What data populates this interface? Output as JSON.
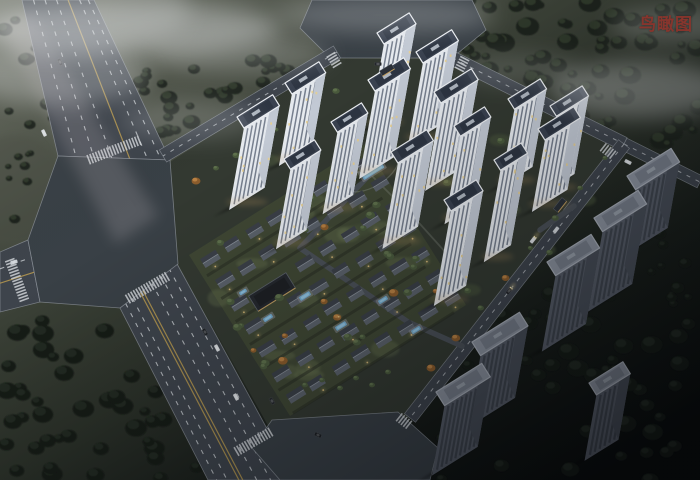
{
  "header": {
    "view_label": "鸟瞰图"
  },
  "palette": {
    "label_red": "#8b342c",
    "road": "#3e444c",
    "plaza": "#394046",
    "curb": "#949aa3",
    "lane_white": "#d7dbdf",
    "lane_yellow": "#bb9c4f",
    "site_ground": "#333931",
    "villa_ground": "#3f4734",
    "lawn": "#76835a",
    "tower_face": "#e6eaef",
    "tower_side": "#c2c9d4",
    "tower_win": "#5b6576",
    "tower_lit": "#e8cf8f",
    "tower_roof": "#3a4250",
    "tower_trim": "#edf0f4",
    "tower_roof_inner": "#2d3542",
    "ctx_face": "#565c67",
    "ctx_side": "#474d57",
    "ctx_rib": "#3d434c",
    "ctx_roof": "#8a919d",
    "villa_roof_front": "#5a616a",
    "villa_roof_back": "#3b4048",
    "villa_ridge": "#878e97",
    "clubhouse": "#25282e",
    "warm": "#cda55f",
    "tree_dark": "#1d231d",
    "tree_dark_hl": "#343d2e",
    "tree_deep": "#141a15",
    "tree_deep_hl": "#262e24",
    "tree_green": "#49593c",
    "tree_green_hl": "#647650",
    "autumn": "#8a5c2c",
    "autumn_hl": "#c28a4a",
    "pool": "#74accf",
    "pool_hl": "#a9d2e8",
    "fog": "#eef0f2"
  },
  "scene": {
    "canvas": {
      "w": 700,
      "h": 480
    },
    "site_polygon": [
      [
        170,
        162
      ],
      [
        334,
        58
      ],
      [
        460,
        60
      ],
      [
        622,
        145
      ],
      [
        412,
        416
      ],
      [
        296,
        476
      ],
      [
        178,
        264
      ]
    ],
    "villa": {
      "origin": [
        210,
        258
      ],
      "rows": 7,
      "cols": 8,
      "row_step": 27,
      "col_step": 26,
      "field": [
        [
          189,
          255
        ],
        [
          365,
          144
        ],
        [
          466,
          305
        ],
        [
          290,
          416
        ]
      ],
      "clubhouse": {
        "x": 272,
        "y": 292,
        "w": 44,
        "d": 18
      },
      "skip_near": [
        272,
        292,
        26
      ],
      "tree_count": 26,
      "lawn_patches": 14
    },
    "towers": [
      [
        377,
        33,
        38,
        13,
        85
      ],
      [
        416,
        52,
        42,
        13,
        82
      ],
      [
        285,
        83,
        40,
        13,
        72
      ],
      [
        368,
        80,
        42,
        13,
        88
      ],
      [
        434,
        92,
        44,
        13,
        88
      ],
      [
        508,
        99,
        38,
        12,
        78
      ],
      [
        550,
        106,
        38,
        12,
        78
      ],
      [
        237,
        117,
        42,
        13,
        82
      ],
      [
        331,
        122,
        36,
        12,
        82
      ],
      [
        454,
        126,
        36,
        12,
        88
      ],
      [
        538,
        129,
        42,
        13,
        72
      ],
      [
        284,
        159,
        36,
        12,
        80
      ],
      [
        391,
        152,
        42,
        13,
        86
      ],
      [
        494,
        160,
        32,
        12,
        92
      ],
      [
        444,
        200,
        38,
        13,
        95
      ]
    ],
    "context_buildings": [
      [
        627,
        176,
        52,
        16,
        66
      ],
      [
        594,
        218,
        52,
        16,
        80
      ],
      [
        547,
        262,
        52,
        16,
        76
      ],
      [
        472,
        342,
        56,
        16,
        72
      ],
      [
        436,
        392,
        54,
        16,
        70
      ],
      [
        589,
        383,
        40,
        14,
        66
      ]
    ],
    "roads": {
      "wide": [
        {
          "name": "avenue-northwest",
          "e1": [
            [
              22,
              0
            ],
            [
              58,
              156
            ]
          ],
          "e2": [
            [
              94,
              0
            ],
            [
              170,
              160
            ]
          ],
          "dashes": [
            0.16,
            0.32,
            0.48,
            0.8,
            0.92
          ],
          "yellow": [
            0.64
          ]
        },
        {
          "name": "avenue-south",
          "e1": [
            [
              176,
              262
            ],
            [
              295,
              480
            ]
          ],
          "e2": [
            [
              120,
              308
            ],
            [
              208,
              480
            ]
          ],
          "dashes": [
            0.13,
            0.28,
            0.44,
            0.78,
            0.9
          ],
          "yellow": [
            0.6,
            0.645
          ]
        },
        {
          "name": "street-west",
          "e1": [
            [
              0,
              252
            ],
            [
              28,
              240
            ]
          ],
          "e2": [
            [
              0,
              312
            ],
            [
              40,
              302
            ]
          ],
          "dashes": [
            0.28
          ],
          "yellow": [
            0.52
          ]
        }
      ],
      "simple": [
        {
          "name": "street-site-northwest",
          "a": [
            337,
            52
          ],
          "b": [
            163,
            156
          ],
          "w": 14,
          "dash": true
        },
        {
          "name": "street-site-northeast",
          "a": [
            452,
            58
          ],
          "b": [
            624,
            144
          ],
          "w": 14,
          "dash": true
        },
        {
          "name": "street-east-exit",
          "a": [
            624,
            144
          ],
          "b": [
            700,
            182
          ],
          "w": 13,
          "dash": true
        },
        {
          "name": "street-site-east",
          "a": [
            624,
            144
          ],
          "b": [
            410,
            418
          ],
          "w": 14,
          "dash": true
        },
        {
          "name": "street-north-stub",
          "a": [
            390,
            56
          ],
          "b": [
            384,
            88
          ],
          "w": 10,
          "dash": false
        }
      ],
      "plazas": [
        {
          "name": "intersection-north",
          "pts": [
            [
              312,
              0
            ],
            [
              472,
              0
            ],
            [
              486,
              30
            ],
            [
              452,
              58
            ],
            [
              330,
              58
            ],
            [
              300,
              28
            ]
          ]
        },
        {
          "name": "intersection-west",
          "pts": [
            [
              58,
              156
            ],
            [
              170,
              160
            ],
            [
              178,
              264
            ],
            [
              120,
              308
            ],
            [
              40,
              302
            ],
            [
              28,
              240
            ]
          ]
        },
        {
          "name": "intersection-south",
          "pts": [
            [
              272,
              420
            ],
            [
              398,
              412
            ],
            [
              438,
              448
            ],
            [
              430,
              480
            ],
            [
              280,
              480
            ],
            [
              252,
              448
            ]
          ]
        }
      ],
      "zebras": [
        [
          114,
          150,
          69,
          54
        ],
        [
          147,
          288,
          60,
          46
        ],
        [
          17,
          280,
          -20,
          42
        ],
        [
          334,
          60,
          -31,
          12
        ],
        [
          462,
          64,
          27,
          12
        ],
        [
          608,
          151,
          -52,
          12
        ],
        [
          404,
          421,
          -52,
          12
        ],
        [
          253,
          442,
          60,
          40
        ]
      ],
      "drives": [
        [
          [
            386,
            84
          ],
          [
            372,
            172
          ],
          [
            300,
            248
          ]
        ],
        [
          [
            300,
            248
          ],
          [
            408,
            322
          ],
          [
            462,
            346
          ]
        ],
        [
          [
            540,
            230
          ],
          [
            574,
            206
          ]
        ]
      ]
    },
    "forest": [
      {
        "name": "forest-northeast",
        "rect": [
          408,
          0,
          292,
          150
        ],
        "n": 62,
        "rmin": 4,
        "rmax": 12,
        "clip": "ne",
        "deep": false
      },
      {
        "name": "forest-north-band",
        "rect": [
          140,
          58,
          205,
          84
        ],
        "n": 26,
        "rmin": 4,
        "rmax": 9,
        "clip": "nw",
        "deep": false
      },
      {
        "name": "forest-northwest-corner",
        "rect": [
          0,
          16,
          82,
          118
        ],
        "n": 15,
        "rmin": 4,
        "rmax": 9,
        "deep": false
      },
      {
        "name": "forest-west-strip",
        "rect": [
          0,
          132,
          44,
          88
        ],
        "n": 8,
        "rmin": 3,
        "rmax": 6,
        "deep": false
      },
      {
        "name": "forest-southwest",
        "rect": [
          0,
          320,
          215,
          160
        ],
        "n": 44,
        "rmin": 5,
        "rmax": 11,
        "clip": "sw",
        "deep": true
      },
      {
        "name": "forest-southeast",
        "rect": [
          430,
          294,
          270,
          186
        ],
        "n": 48,
        "rmin": 5,
        "rmax": 11,
        "clip": "se",
        "deep": true
      },
      {
        "name": "forest-east-strip",
        "rect": [
          646,
          222,
          54,
          96
        ],
        "n": 10,
        "rmin": 3,
        "rmax": 7,
        "deep": true
      }
    ],
    "tower_lawns": [
      [
        268,
        160
      ],
      [
        310,
        200
      ],
      [
        360,
        230
      ],
      [
        420,
        260
      ],
      [
        470,
        290
      ],
      [
        300,
        130
      ],
      [
        390,
        150
      ],
      [
        450,
        180
      ],
      [
        510,
        210
      ],
      [
        545,
        250
      ],
      [
        430,
        120
      ],
      [
        500,
        140
      ],
      [
        560,
        170
      ],
      [
        585,
        200
      ]
    ],
    "south_trees": [
      [
        305,
        385
      ],
      [
        322,
        380
      ],
      [
        340,
        388
      ],
      [
        356,
        378
      ],
      [
        372,
        385
      ],
      [
        388,
        372
      ]
    ],
    "edge_trees": {
      "a": [
        190,
        175
      ],
      "b": [
        330,
        85
      ],
      "n": 8
    },
    "road_trees": {
      "a": [
        614,
        160
      ],
      "b": [
        440,
        370
      ],
      "n": 8
    },
    "pools": [
      [
        372,
        170,
        24,
        9
      ],
      [
        268,
        318,
        10,
        4
      ],
      [
        305,
        296,
        12,
        4.5
      ],
      [
        341,
        326,
        12,
        4.5
      ],
      [
        383,
        300,
        10,
        4
      ],
      [
        416,
        330,
        10,
        4
      ],
      [
        243,
        292,
        8,
        3.5
      ]
    ],
    "cars": [
      [
        44,
        133,
        65,
        "#dde1e4",
        0
      ],
      [
        60,
        62,
        65,
        "#2a2e33",
        0
      ],
      [
        378,
        64,
        0,
        "#23262b",
        0
      ],
      [
        14,
        262,
        -15,
        "#ccd1d6",
        0
      ],
      [
        533,
        240,
        -52,
        "#d9dde1",
        1
      ],
      [
        556,
        230,
        -52,
        "#ced3d8",
        0
      ],
      [
        509,
        291,
        -52,
        "#24272c",
        1
      ],
      [
        217,
        348,
        62,
        "#d9dde0",
        0
      ],
      [
        236,
        397,
        62,
        "#d9dde0",
        0
      ],
      [
        272,
        401,
        62,
        "#26292d",
        0
      ],
      [
        318,
        435,
        25,
        "#1c1f23",
        0
      ],
      [
        205,
        332,
        62,
        "#202428",
        0
      ],
      [
        628,
        162,
        27,
        "#d6dade",
        0
      ]
    ],
    "gates": [
      {
        "x": 387,
        "y": 70,
        "rot": -31
      },
      {
        "x": 560,
        "y": 205,
        "rot": -52
      }
    ],
    "fog": [
      [
        130,
        28,
        150,
        26,
        0.42
      ],
      [
        60,
        75,
        90,
        30,
        0.3
      ],
      [
        240,
        55,
        90,
        18,
        0.22
      ],
      [
        385,
        15,
        110,
        18,
        0.25
      ],
      [
        640,
        90,
        90,
        28,
        0.33
      ],
      [
        680,
        25,
        70,
        18,
        0.22
      ],
      [
        190,
        120,
        70,
        20,
        0.18
      ],
      [
        520,
        70,
        60,
        16,
        0.15
      ]
    ],
    "streak": [
      [
        0,
        26
      ],
      [
        30,
        12
      ],
      [
        158,
        216
      ],
      [
        116,
        244
      ]
    ]
  }
}
